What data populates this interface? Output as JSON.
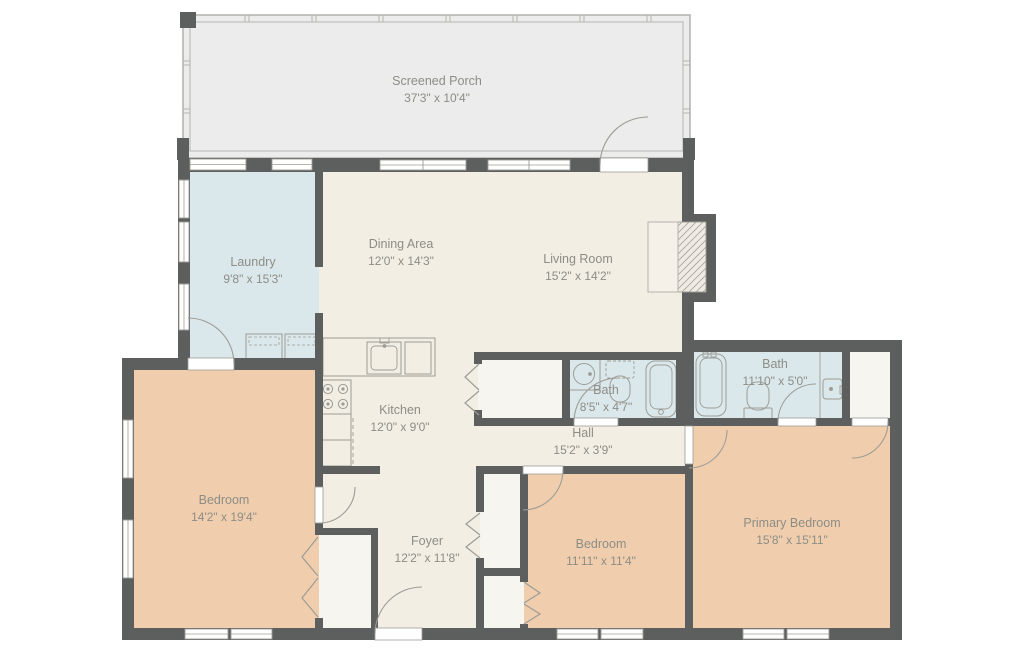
{
  "title": "Floor plan",
  "rooms": [
    {
      "name": "Screened Porch",
      "dims": "37'3\" x 10'4\""
    },
    {
      "name": "Laundry",
      "dims": "9'8\" x 15'3\""
    },
    {
      "name": "Dining Area",
      "dims": "12'0\" x 14'3\""
    },
    {
      "name": "Living Room",
      "dims": "15'2\" x 14'2\""
    },
    {
      "name": "Kitchen",
      "dims": "12'0\" x 9'0\""
    },
    {
      "name": "Bath",
      "dims": "8'5\" x 4'7\""
    },
    {
      "name": "Bath",
      "dims": "11'10\" x 5'0\""
    },
    {
      "name": "Hall",
      "dims": "15'2\" x 3'9\""
    },
    {
      "name": "Bedroom",
      "dims": "14'2\" x 19'4\""
    },
    {
      "name": "Foyer",
      "dims": "12'2\" x 11'8\""
    },
    {
      "name": "Bedroom",
      "dims": "11'11\" x 11'4\""
    },
    {
      "name": "Primary Bedroom",
      "dims": "15'8\" x 15'11\""
    }
  ],
  "colors": {
    "wall": "#5d5e5e",
    "cream": "#f3eee4",
    "tan": "#f0cead",
    "blue": "#dbe8eb",
    "porch": "#ebeceb",
    "closet": "#f7f5ef",
    "line": "#9c9c96",
    "porch_line": "#b5b6b2",
    "hearth": "#f5f1e8",
    "text": "#8d8d86",
    "background": "#ffffff"
  }
}
